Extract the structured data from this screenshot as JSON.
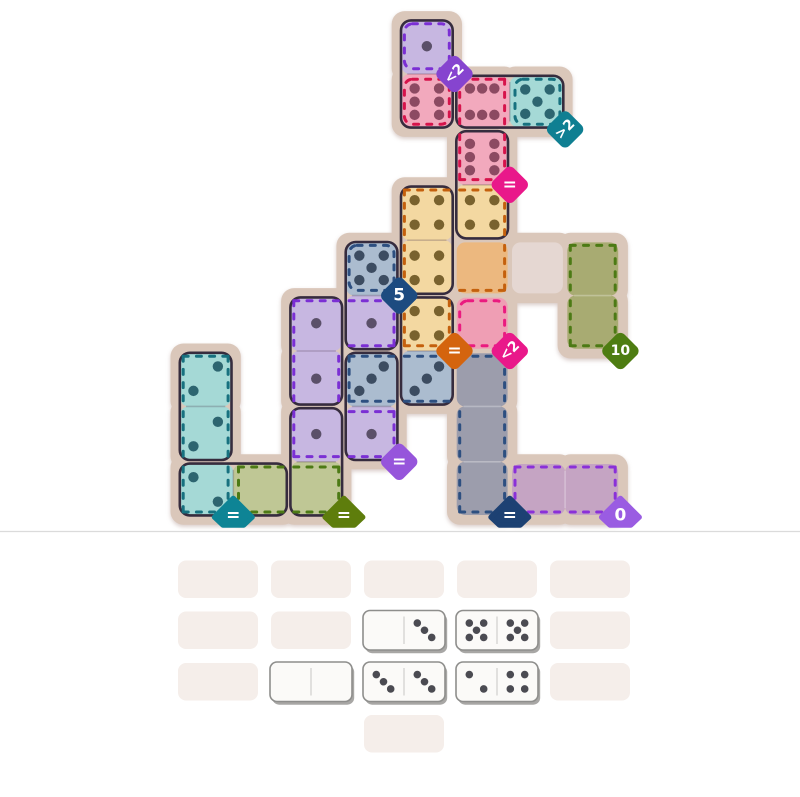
{
  "page": {
    "background": "#ffffff",
    "divider_color": "#dbdbdb"
  },
  "board": {
    "base_color": "#dac7ba",
    "outline_color": "#362c3e",
    "regions": [
      {
        "name": "purple-top",
        "dash": "#7b2fd4",
        "fill": "#c7b7e1",
        "pip": "#5b5069",
        "cells": [
          [
            4,
            0
          ]
        ],
        "badge": {
          "label": "<2",
          "color": "#8644cf",
          "cell": [
            4,
            0
          ],
          "rotated": true
        }
      },
      {
        "name": "pink-solo",
        "dash": "#d6134b",
        "fill": "#f2a9bd",
        "pip": "#8c4a62",
        "cells": [
          [
            4,
            1
          ]
        ]
      },
      {
        "name": "pink-pair",
        "dash": "#d6134b",
        "fill": "#f2a9bd",
        "pip": "#8c4a62",
        "cells": [
          [
            5,
            1
          ],
          [
            5,
            2
          ]
        ],
        "badge": {
          "label": "=",
          "color": "#e9188a",
          "cell": [
            5,
            2
          ]
        }
      },
      {
        "name": "teal-right",
        "dash": "#17717f",
        "fill": "#a5d9d6",
        "pip": "#2d6570",
        "cells": [
          [
            6,
            1
          ]
        ],
        "badge": {
          "label": ">2",
          "color": "#0f7f92",
          "cell": [
            6,
            1
          ],
          "rotated": true
        }
      },
      {
        "name": "orange",
        "dash": "#c4600d",
        "fill": "#f3d8a1",
        "empty": "#ecb87f",
        "pip": "#79622e",
        "cells": [
          [
            4,
            3
          ],
          [
            5,
            3
          ],
          [
            4,
            4
          ],
          [
            5,
            4
          ],
          [
            4,
            5
          ]
        ],
        "badge": {
          "label": "=",
          "color": "#d4640e",
          "cell": [
            4,
            5
          ]
        }
      },
      {
        "name": "navy-five",
        "dash": "#2d4f80",
        "fill": "#abbccf",
        "pip": "#3c4c61",
        "cells": [
          [
            3,
            4
          ]
        ],
        "badge": {
          "label": "5",
          "color": "#1d4b80",
          "cell": [
            3,
            4
          ]
        }
      },
      {
        "name": "purple-left",
        "dash": "#7b2fd4",
        "fill": "#c7b7e1",
        "pip": "#5b5069",
        "cells": [
          [
            2,
            5
          ],
          [
            3,
            5
          ],
          [
            2,
            6
          ],
          [
            2,
            7
          ],
          [
            3,
            7
          ]
        ],
        "badge": {
          "label": "=",
          "color": "#9655db",
          "cell": [
            3,
            7
          ]
        }
      },
      {
        "name": "pink-empty",
        "dash": "#ea1a7f",
        "empty": "#ef9eb4",
        "cells": [
          [
            5,
            5
          ]
        ],
        "badge": {
          "label": "<2",
          "color": "#e9188a",
          "cell": [
            5,
            5
          ],
          "rotated": true
        }
      },
      {
        "name": "green-right",
        "dash": "#4c7a15",
        "empty": "#a8ab72",
        "cells": [
          [
            7,
            4
          ],
          [
            7,
            5
          ]
        ],
        "badge": {
          "label": "10",
          "color": "#4e7d12",
          "cell": [
            7,
            5
          ]
        }
      },
      {
        "name": "navy-el",
        "dash": "#2d4f80",
        "fill": "#abbccf",
        "empty": "#9c9dac",
        "pip": "#3c4c61",
        "cells": [
          [
            3,
            6
          ],
          [
            4,
            6
          ],
          [
            5,
            6
          ],
          [
            5,
            7
          ],
          [
            5,
            8
          ]
        ],
        "badge": {
          "label": "=",
          "color": "#1d4173",
          "cell": [
            5,
            8
          ]
        }
      },
      {
        "name": "teal-left",
        "dash": "#17717f",
        "fill": "#a5d9d6",
        "pip": "#2d6570",
        "cells": [
          [
            0,
            6
          ],
          [
            0,
            7
          ],
          [
            0,
            8
          ]
        ],
        "badge": {
          "label": "=",
          "color": "#0e8495",
          "cell": [
            0,
            8
          ]
        }
      },
      {
        "name": "green-bl",
        "dash": "#4c7a15",
        "fill": "#bfc795",
        "empty": "#bfc795",
        "cells": [
          [
            1,
            8
          ],
          [
            2,
            8
          ]
        ],
        "badge": {
          "label": "=",
          "color": "#5e7d0c",
          "cell": [
            2,
            8
          ]
        }
      },
      {
        "name": "purple-br",
        "dash": "#8a30d8",
        "empty": "#c5a4c3",
        "cells": [
          [
            6,
            8
          ],
          [
            7,
            8
          ]
        ],
        "badge": {
          "label": "0",
          "color": "#9a5ce2",
          "cell": [
            7,
            8
          ]
        }
      },
      {
        "name": "free-cell",
        "dash": null,
        "empty": "#e5d7d2",
        "cells": [
          [
            6,
            4
          ]
        ]
      }
    ],
    "dominoes": [
      {
        "cells": [
          [
            4,
            0
          ],
          [
            4,
            1
          ]
        ],
        "pips": [
          1,
          6
        ]
      },
      {
        "cells": [
          [
            5,
            1
          ],
          [
            6,
            1
          ]
        ],
        "pips": [
          6,
          5
        ]
      },
      {
        "cells": [
          [
            5,
            2
          ],
          [
            5,
            3
          ]
        ],
        "pips": [
          6,
          4
        ]
      },
      {
        "cells": [
          [
            4,
            3
          ],
          [
            4,
            4
          ]
        ],
        "pips": [
          4,
          4
        ]
      },
      {
        "cells": [
          [
            4,
            5
          ],
          [
            4,
            6
          ]
        ],
        "pips": [
          4,
          3
        ]
      },
      {
        "cells": [
          [
            3,
            4
          ],
          [
            3,
            5
          ]
        ],
        "pips": [
          5,
          1
        ]
      },
      {
        "cells": [
          [
            3,
            6
          ],
          [
            3,
            7
          ]
        ],
        "pips": [
          3,
          1
        ]
      },
      {
        "cells": [
          [
            2,
            5
          ],
          [
            2,
            6
          ]
        ],
        "pips": [
          1,
          1
        ]
      },
      {
        "cells": [
          [
            2,
            7
          ],
          [
            2,
            8
          ]
        ],
        "pips": [
          1,
          0
        ]
      },
      {
        "cells": [
          [
            0,
            6
          ],
          [
            0,
            7
          ]
        ],
        "pips": [
          2,
          2
        ]
      },
      {
        "cells": [
          [
            0,
            8
          ],
          [
            1,
            8
          ]
        ],
        "pips": [
          2,
          0
        ]
      }
    ]
  },
  "tray": {
    "slot_color": "#f5eeea",
    "tile_color": "#fbfaf8",
    "tile_border": "#8e8e8c",
    "tile_shadow": "#a8a7a5",
    "pip_color": "#4b4b52",
    "slots": [
      {
        "row": 0,
        "col": 0
      },
      {
        "row": 0,
        "col": 1
      },
      {
        "row": 0,
        "col": 2
      },
      {
        "row": 0,
        "col": 3
      },
      {
        "row": 0,
        "col": 4
      },
      {
        "row": 1,
        "col": 0
      },
      {
        "row": 1,
        "col": 1
      },
      {
        "row": 1,
        "col": 2,
        "domino": [
          0,
          3
        ]
      },
      {
        "row": 1,
        "col": 3,
        "domino": [
          5,
          5
        ]
      },
      {
        "row": 1,
        "col": 4
      },
      {
        "row": 2,
        "col": 0
      },
      {
        "row": 2,
        "col": 1,
        "domino": [
          0,
          0
        ]
      },
      {
        "row": 2,
        "col": 2,
        "domino": [
          3,
          3
        ]
      },
      {
        "row": 2,
        "col": 3,
        "domino": [
          2,
          4
        ]
      },
      {
        "row": 2,
        "col": 4
      },
      {
        "row": 3,
        "col": 2
      }
    ]
  }
}
